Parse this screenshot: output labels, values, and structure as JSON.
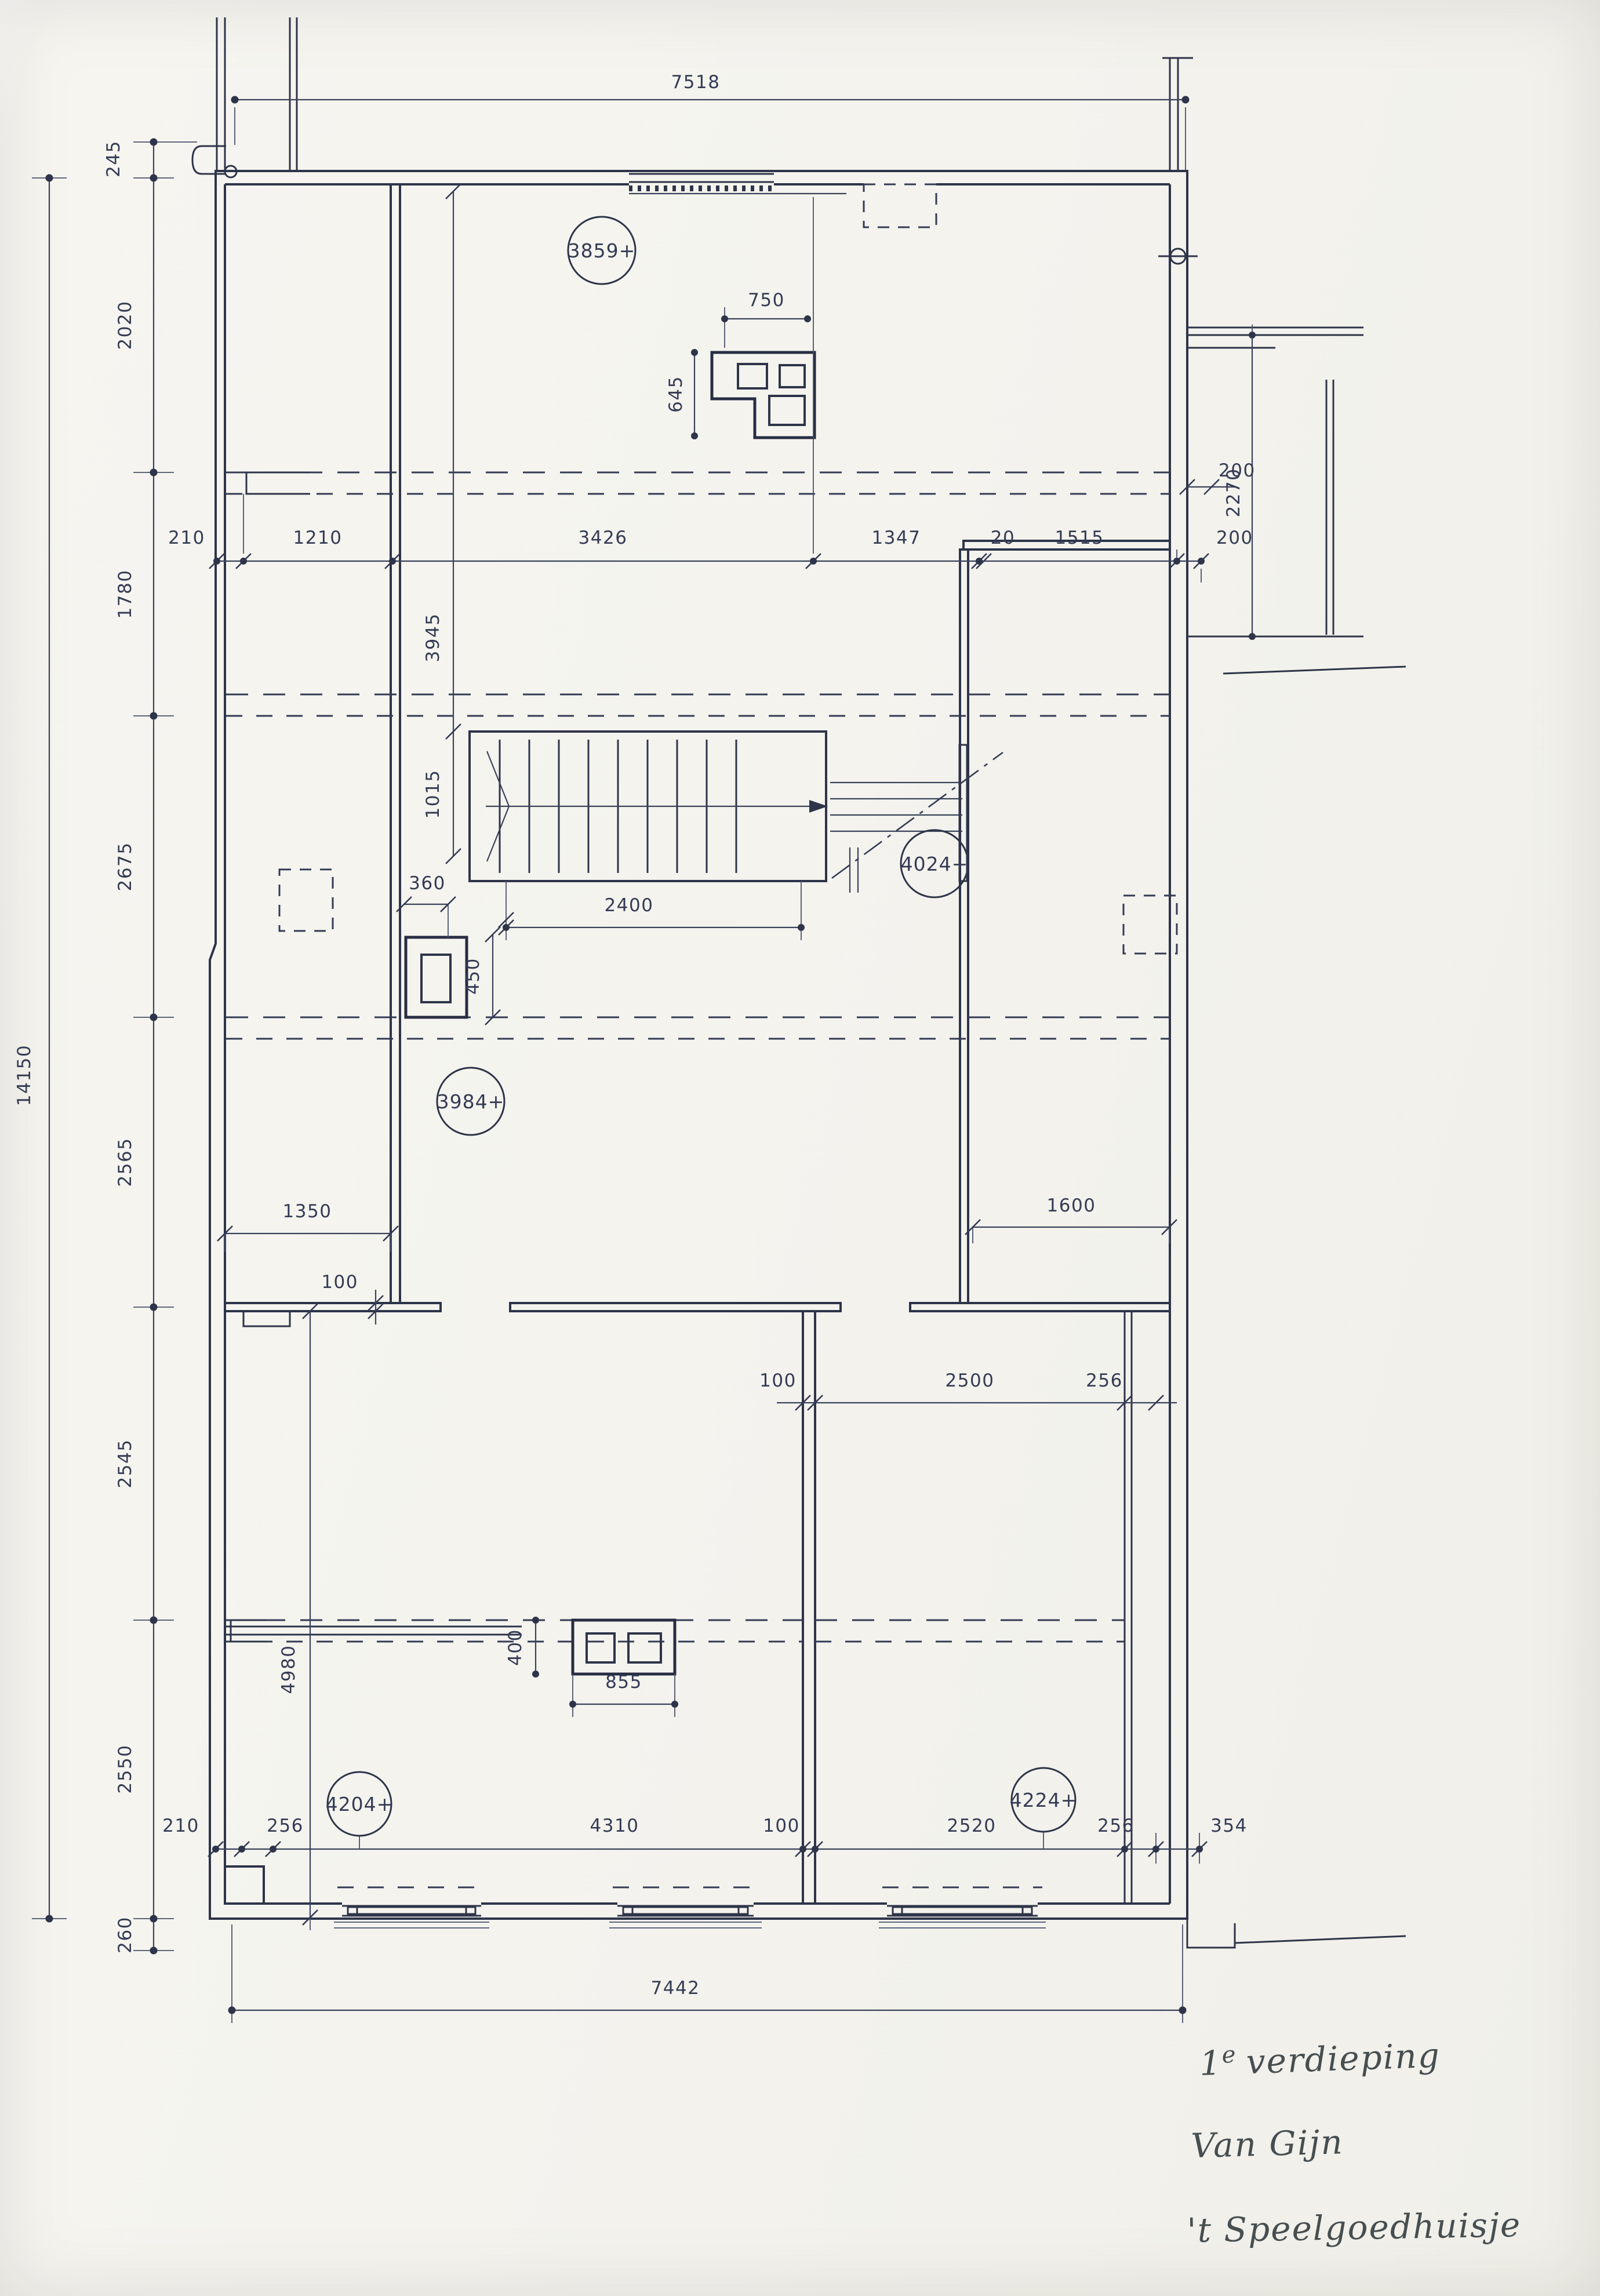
{
  "sheet": {
    "handwriting": {
      "sup_base": "1",
      "sup": "e",
      "line1_rest": "verdieping",
      "line2": "Van Gijn",
      "line3": "'t Speelgoedhuisje"
    },
    "levels": {
      "l1": "3859+",
      "l2": "4024+",
      "l3": "3984+",
      "l4": "4204+",
      "l5": "4224+"
    },
    "dims": {
      "top_total": "7518",
      "overall_height": "14150",
      "left245": "245",
      "left2020": "2020",
      "left1780": "1780",
      "left2675": "2675",
      "left2565": "2565",
      "left2545": "2545",
      "left2550": "2550",
      "left260": "260",
      "r1_210": "210",
      "r1_1210": "1210",
      "r1_3426": "3426",
      "r1_1347": "1347",
      "r1_20": "20",
      "r1_1515": "1515",
      "r1_200": "200",
      "v3945": "3945",
      "v1015": "1015",
      "chim750": "750",
      "chim645": "645",
      "stair2400": "2400",
      "duct360": "360",
      "duct450": "450",
      "annex2270": "2270",
      "annex200": "200",
      "mid1350": "1350",
      "mid100": "100",
      "mid1600": "1600",
      "low100": "100",
      "low2500": "2500",
      "low256": "256",
      "v4980": "4980",
      "chim400": "400",
      "chim855": "855",
      "b210": "210",
      "b256a": "256",
      "b4310": "4310",
      "b100": "100",
      "b2520": "2520",
      "b256b": "256",
      "b354": "354",
      "bottom_total": "7442"
    }
  }
}
